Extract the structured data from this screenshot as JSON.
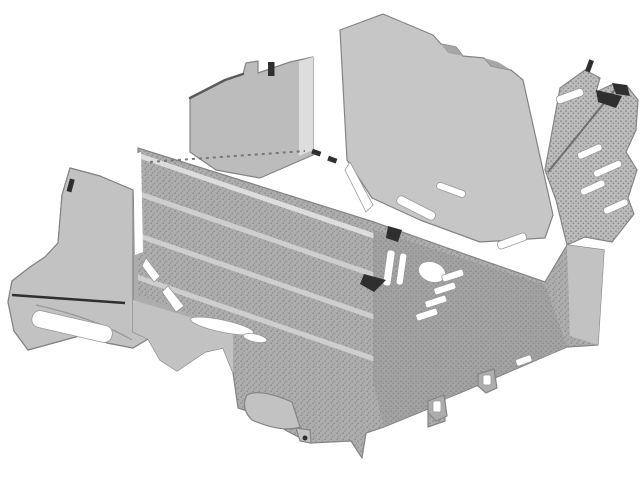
{
  "figure": {
    "kind": "scanned monochrome technical line-art illustration",
    "subject": "automotive climate-control (HVAC) housing assembly",
    "view": "isometric three-quarter view from upper front-left",
    "style": "grayscale stippled halftone shading on white background",
    "visible_text": "none"
  },
  "canvas": {
    "width": 640,
    "height": 480
  },
  "colors": {
    "background": "#ffffff",
    "lid": "#c6c6c6",
    "wall": "#bcbcbc",
    "body": "#adadad",
    "body_dark": "#a1a1a1",
    "flange": "#c2c2c2",
    "strip_light": "#dddddd",
    "rib_stripe": "#cecece",
    "highlight": "#ffffff",
    "texture_dot": "#8e8e8e",
    "outline": "#848484",
    "accent_dark": "#2f2f2f"
  },
  "components": [
    {
      "name": "main-housing-body",
      "shading": "stippled halftone"
    },
    {
      "name": "ribbed-core-front-face",
      "feature": "parallel diagonal rib stripes"
    },
    {
      "name": "top-lid-panel",
      "shading": "smooth light gray"
    },
    {
      "name": "left-end-wall-panel",
      "shading": "smooth, notched top edge with dark tick mark"
    },
    {
      "name": "left-mounting-bracket",
      "feature": "oblong slot opening and thin dark rib line"
    },
    {
      "name": "right-end-bracket",
      "feature": "angled vent slots and dark hook"
    },
    {
      "name": "center-clip-cluster",
      "feature": "white posts, wedges and stair-step tabs"
    },
    {
      "name": "lower-drain-pod",
      "shading": "smooth"
    },
    {
      "name": "bottom-clip-tabs",
      "count": 2
    }
  ]
}
